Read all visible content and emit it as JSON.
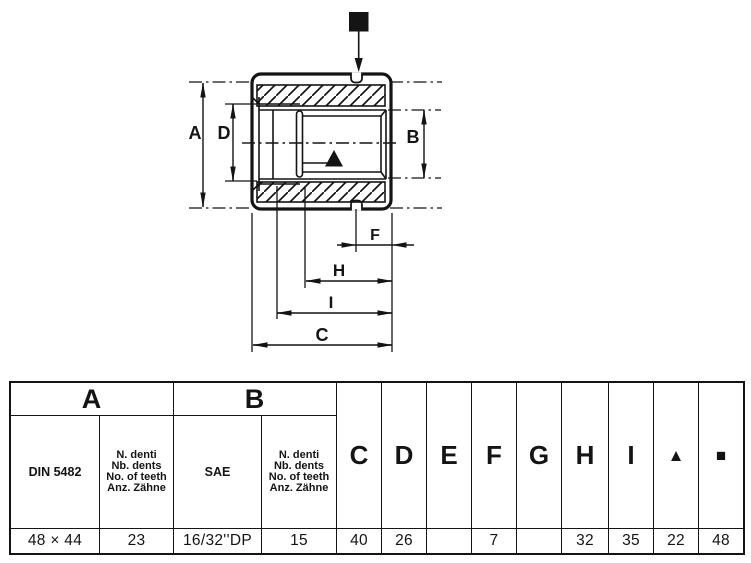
{
  "drawing": {
    "dim_labels": {
      "A": "A",
      "B": "B",
      "C": "C",
      "D": "D",
      "F": "F",
      "H": "H",
      "I": "I"
    }
  },
  "table": {
    "group_a": {
      "label": "A",
      "standard": "DIN 5482",
      "standard_value": "48 × 44",
      "teeth_lines": [
        "N. denti",
        "Nb. dents",
        "No. of teeth",
        "Anz. Zähne"
      ],
      "teeth_value": "23"
    },
    "group_b": {
      "label": "B",
      "standard": "SAE",
      "standard_value": "16/32''DP",
      "teeth_lines": [
        "N. denti",
        "Nb. dents",
        "No. of teeth",
        "Anz. Zähne"
      ],
      "teeth_value": "15"
    },
    "dims": [
      {
        "label": "C",
        "value": "40"
      },
      {
        "label": "D",
        "value": "26"
      },
      {
        "label": "E",
        "value": ""
      },
      {
        "label": "F",
        "value": "7"
      },
      {
        "label": "G",
        "value": ""
      },
      {
        "label": "H",
        "value": "32"
      },
      {
        "label": "I",
        "value": "35"
      },
      {
        "label": "▲",
        "value": "22"
      },
      {
        "label": "■",
        "value": "48"
      }
    ]
  },
  "colors": {
    "ink": "#141414",
    "paper": "#ffffff"
  }
}
